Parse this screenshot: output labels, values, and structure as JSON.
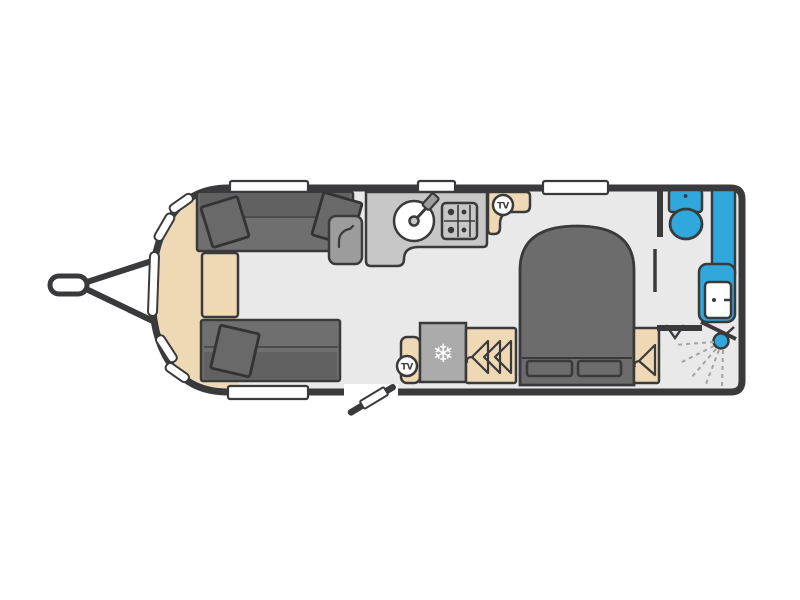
{
  "diagram": {
    "type": "caravan-floorplan-top-view",
    "labels": {
      "tv_front": "TV",
      "tv_rear": "TV"
    },
    "icons": {
      "freezer_snowflake": "❄",
      "fixture_names": [
        "tow-hitch",
        "front-windows",
        "parallel-sofas",
        "front-chest",
        "cupboard-door-swing",
        "kitchen-sink",
        "gas-hob",
        "tv-point-front",
        "fridge-freezer",
        "tv-point-rear",
        "triple-wardrobe",
        "island-bed",
        "bedside-wardrobe",
        "washroom-partition-door",
        "toilet",
        "washbasin-vanity",
        "shower-head",
        "shower-spray",
        "entrance-door",
        "windows"
      ]
    },
    "colors": {
      "outline": "#3a3a3c",
      "floor": "#e9e9e9",
      "upholstery_gray": "#6f6f6f",
      "furniture_beige": "#eed9b4",
      "kitchen_gray": "#c7c7c7",
      "appliance_gray": "#ababab",
      "plumbing_blue": "#31a8dc",
      "window_white": "#ffffff",
      "background": "#ffffff"
    },
    "zones": {
      "lounge": {
        "fixtures": [
          "sofa-top",
          "sofa-bottom",
          "scatter-cushions",
          "front-chest"
        ]
      },
      "kitchen": {
        "fixtures": [
          "cupboard-with-door-swing",
          "worktop",
          "round-sink-with-tap",
          "four-burner-hob",
          "tv-locker"
        ]
      },
      "midship": {
        "fixtures": [
          "entrance-door",
          "tv-locker",
          "fridge-freezer",
          "triple-hanging-wardrobe"
        ]
      },
      "bedroom": {
        "fixtures": [
          "island-bed",
          "two-pillows",
          "bedside-wardrobe-left",
          "bedside-wardrobe-right"
        ]
      },
      "washroom": {
        "fixtures": [
          "toilet-with-cistern",
          "vanity-with-basin-and-tap",
          "shower-with-spray",
          "bifold-door-mark"
        ]
      }
    }
  }
}
